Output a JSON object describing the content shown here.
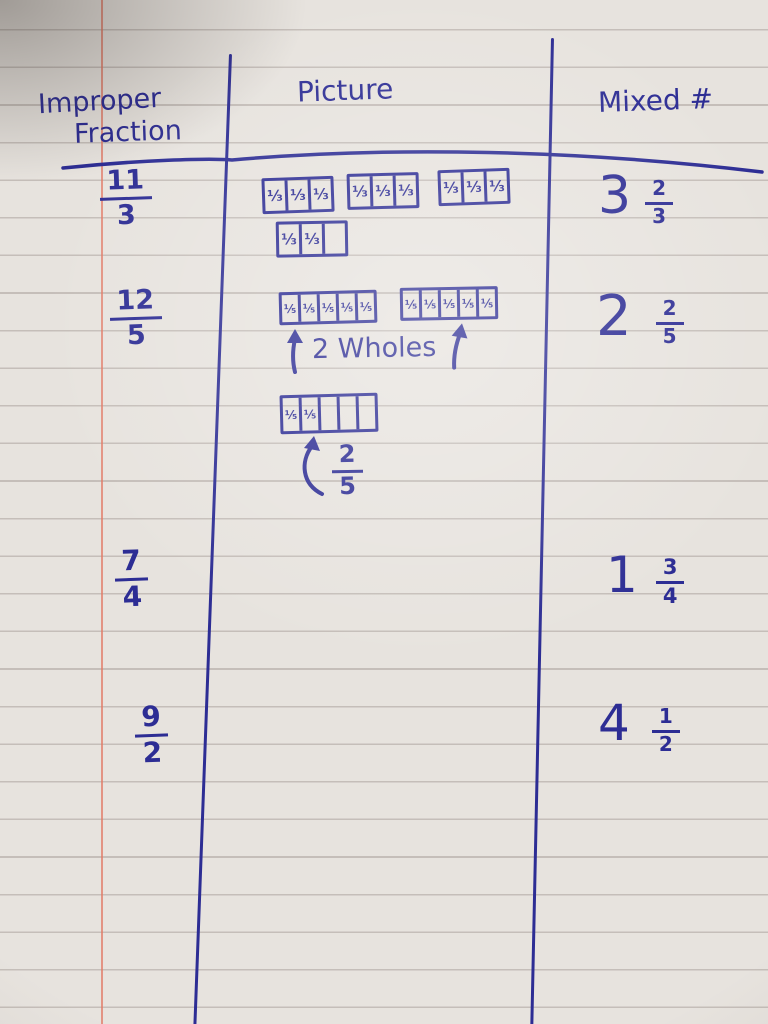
{
  "colors": {
    "ink": "#2d2d94",
    "paper": "#e7e3de",
    "rule_line": "#a9a09b",
    "margin_line": "#e27a66"
  },
  "headers": {
    "col1_line1": "Improper",
    "col1_line2": "Fraction",
    "col2": "Picture",
    "col3": "Mixed #"
  },
  "rows": [
    {
      "improper": {
        "numerator": "11",
        "denominator": "3"
      },
      "mixed": {
        "whole": "3",
        "numerator": "2",
        "denominator": "3"
      },
      "picture": {
        "bars": [
          {
            "cells": 3,
            "filled": 3,
            "label": "⅓"
          },
          {
            "cells": 3,
            "filled": 3,
            "label": "⅓"
          },
          {
            "cells": 3,
            "filled": 3,
            "label": "⅓"
          },
          {
            "cells": 3,
            "filled": 2,
            "label": "⅓"
          }
        ]
      }
    },
    {
      "improper": {
        "numerator": "12",
        "denominator": "5"
      },
      "mixed": {
        "whole": "2",
        "numerator": "2",
        "denominator": "5"
      },
      "picture": {
        "bars": [
          {
            "cells": 5,
            "filled": 5,
            "label": "⅕"
          },
          {
            "cells": 5,
            "filled": 5,
            "label": "⅕"
          },
          {
            "cells": 5,
            "filled": 2,
            "label": "⅕"
          }
        ],
        "wholes_label": "2 Wholes",
        "part_label": {
          "numerator": "2",
          "denominator": "5"
        }
      }
    },
    {
      "improper": {
        "numerator": "7",
        "denominator": "4"
      },
      "mixed": {
        "whole": "1",
        "numerator": "3",
        "denominator": "4"
      },
      "picture": {
        "bars": []
      }
    },
    {
      "improper": {
        "numerator": "9",
        "denominator": "2"
      },
      "mixed": {
        "whole": "4",
        "numerator": "1",
        "denominator": "2"
      },
      "picture": {
        "bars": []
      }
    }
  ]
}
